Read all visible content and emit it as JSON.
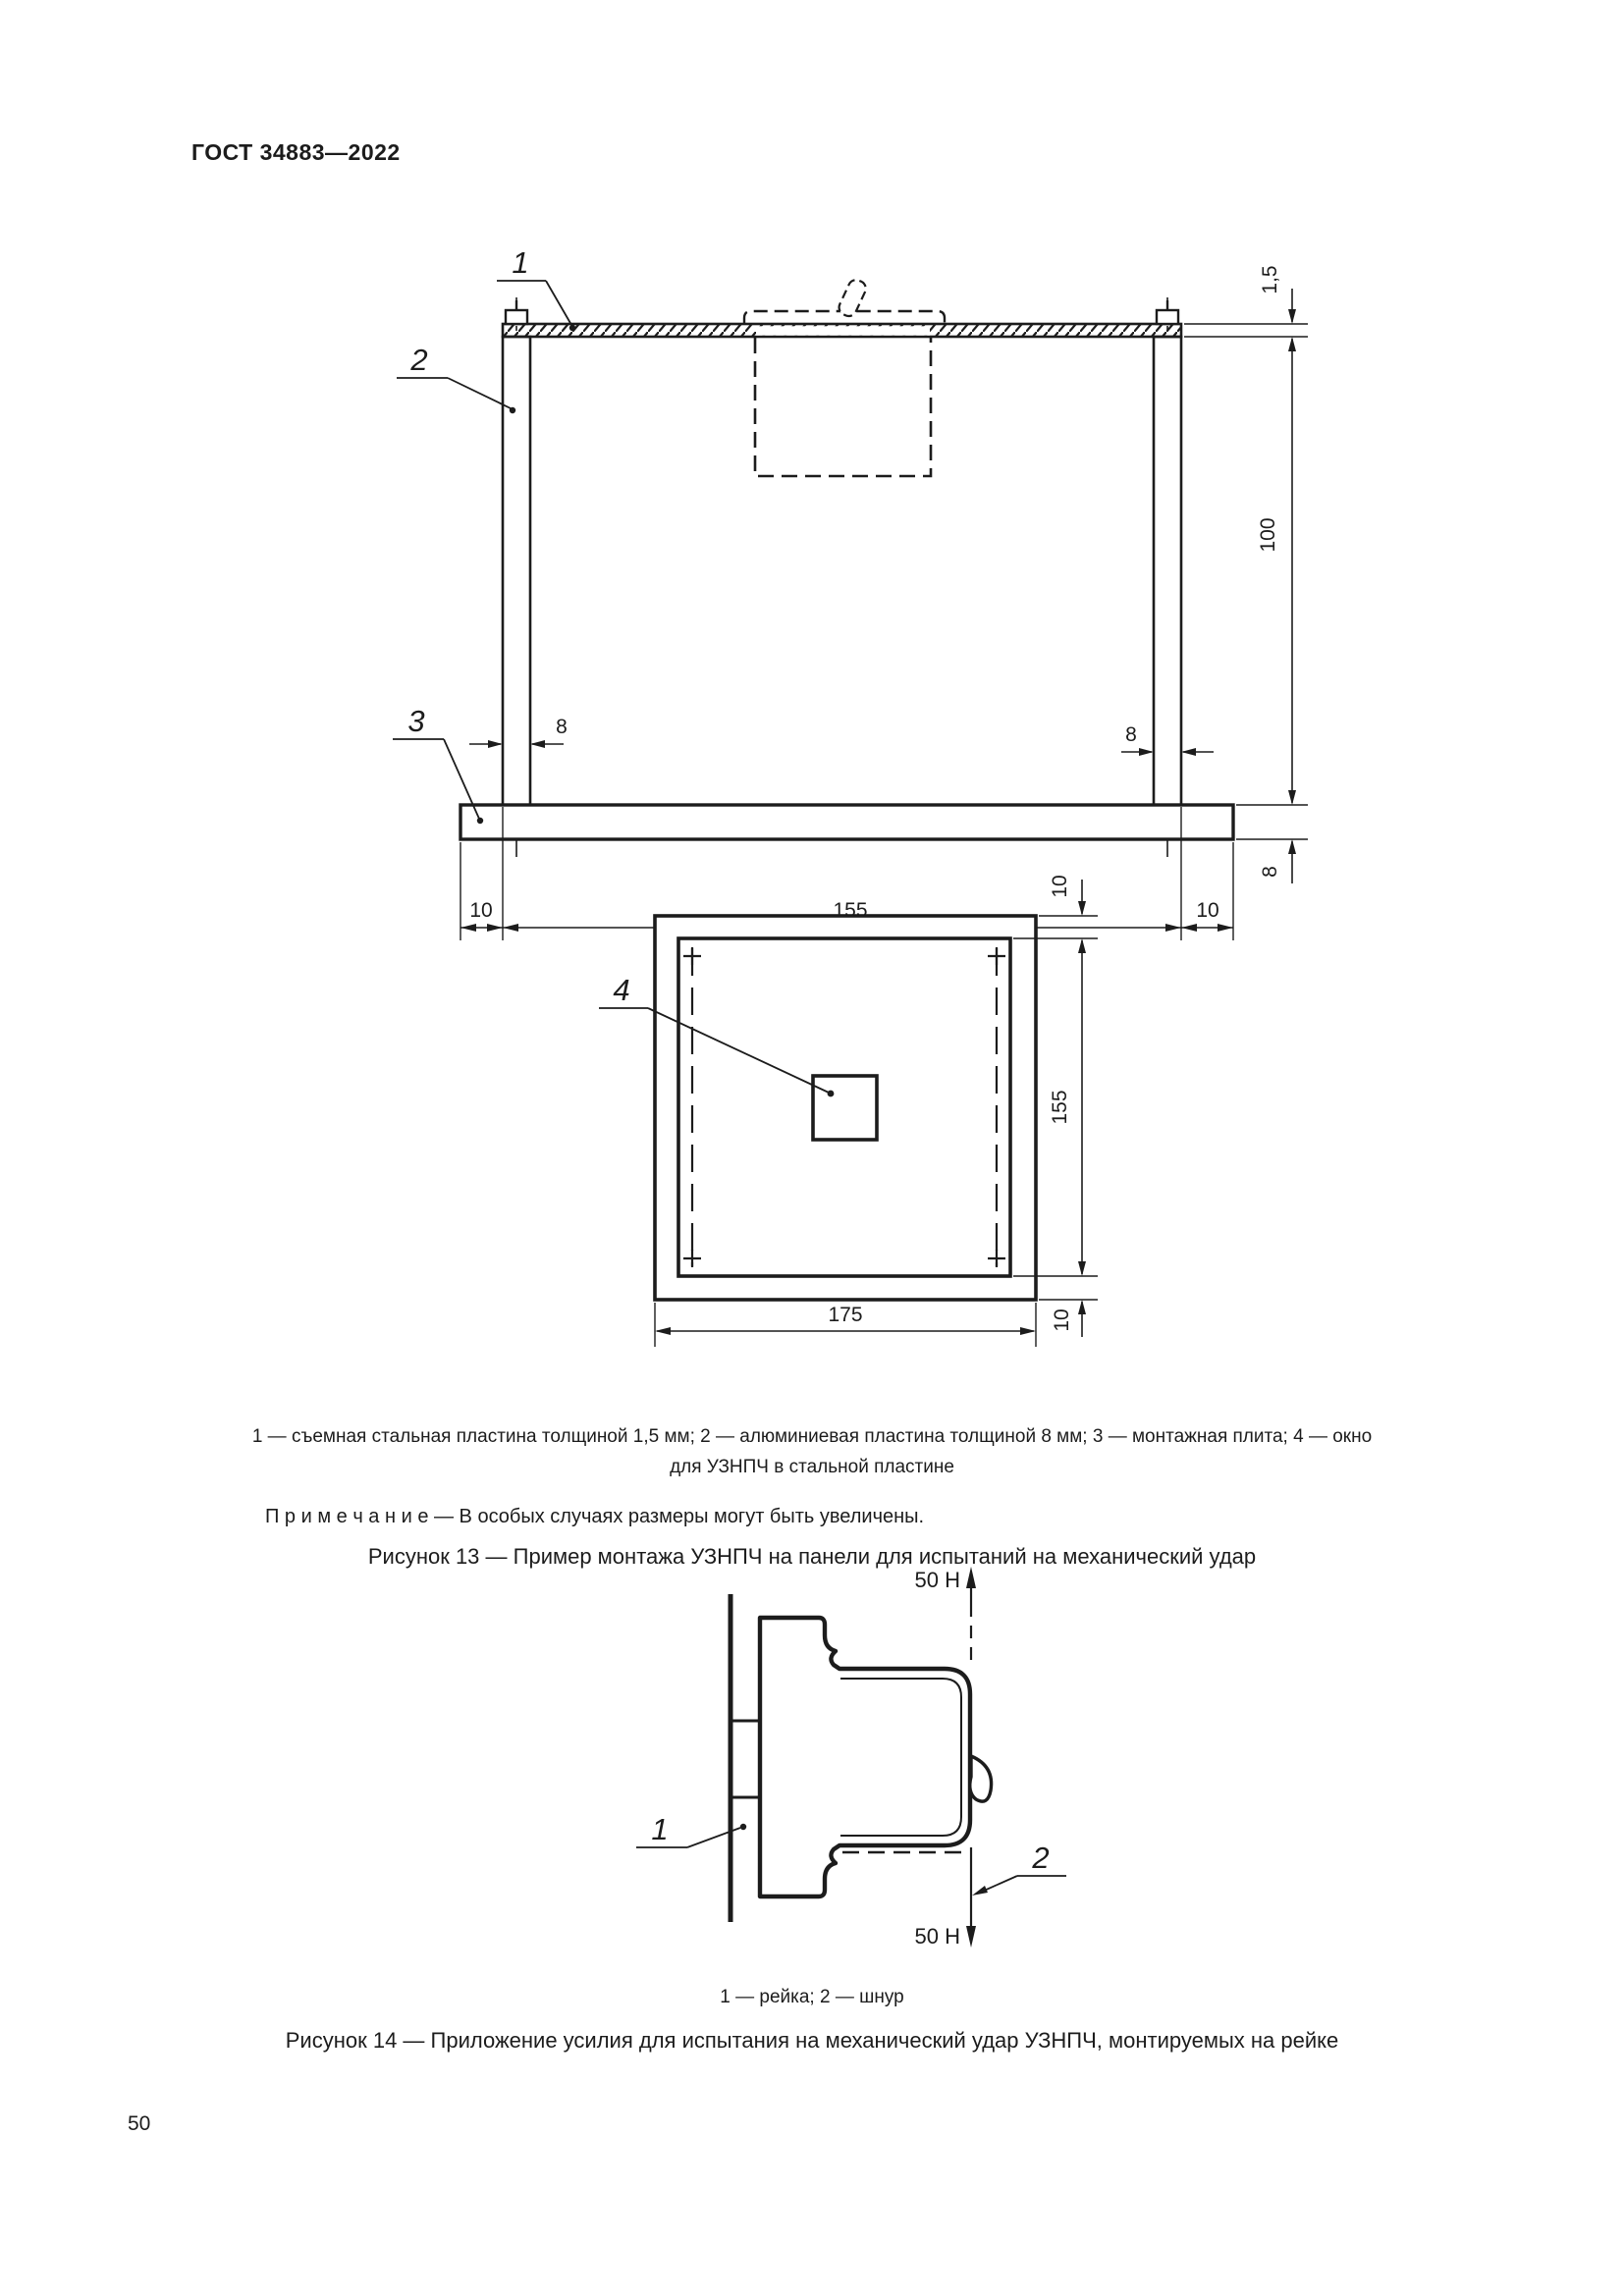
{
  "page": {
    "header": "ГОСТ 34883—2022",
    "number": "50"
  },
  "colors": {
    "ink": "#1c1c1c",
    "paper": "#ffffff"
  },
  "figure13": {
    "part_labels": {
      "l1": "1",
      "l2": "2",
      "l3": "3",
      "l4": "4"
    },
    "dims": {
      "plate_thickness": "1,5",
      "height": "100",
      "post_width_left": "8",
      "post_width_right": "8",
      "base_thickness": "8",
      "margin_left": "10",
      "span": "155",
      "margin_right": "10",
      "plan_top": "10",
      "plan_side": "155",
      "plan_bottom": "10",
      "plan_width": "175"
    },
    "legend_line1": "1 — съемная стальная пластина толщиной 1,5 мм; 2 — алюминиевая пластина толщиной 8 мм; 3 — монтажная плита; 4 — окно",
    "legend_line2": "для УЗНПЧ в стальной пластине",
    "note": "П р и м е ч а н и е   — В особых случаях размеры могут быть увеличены.",
    "caption": "Рисунок 13 — Пример монтажа УЗНПЧ на панели для испытаний на механический удар"
  },
  "figure14": {
    "force_top": "50 Н",
    "force_bottom": "50 Н",
    "part_labels": {
      "l1": "1",
      "l2": "2"
    },
    "legend": "1 — рейка; 2 — шнур",
    "caption": "Рисунок 14 — Приложение усилия для испытания на механический удар УЗНПЧ, монтируемых на рейке"
  }
}
